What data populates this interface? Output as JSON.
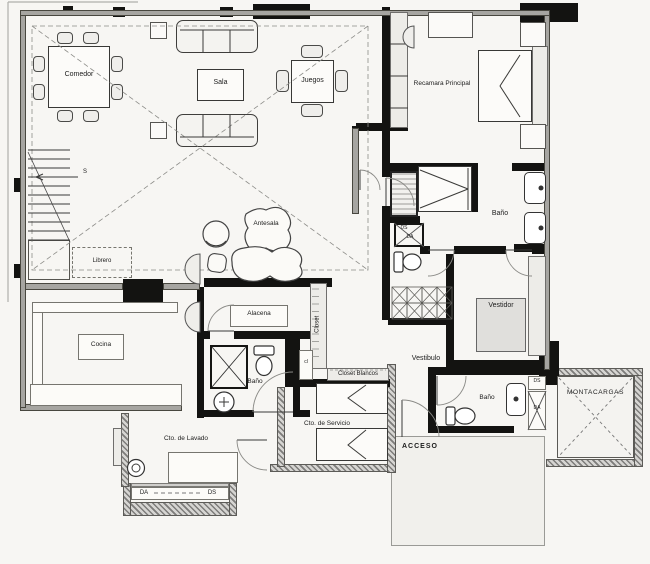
{
  "labels": {
    "comedor": "Comedor",
    "sala": "Sala",
    "juegos": "Juegos",
    "recamara": "Recamara Principal",
    "antesala": "Antesala",
    "librero": "Librero",
    "stair_s": "S",
    "alacena": "Alacena",
    "closet": "Closet",
    "cocina": "Cocina",
    "bano_principal": "Baño",
    "vestidor": "Vestidor",
    "vestibulo": "Vestibulo",
    "closet_blancos": "Closet Blancos",
    "cl": "cl",
    "bano_servicio": "Baño",
    "cto_lavado": "Cto. de Lavado",
    "cto_servicio": "Cto. de Servicio",
    "da_balcon": "DA",
    "ds_balcon": "DS",
    "acceso": "ACCESO",
    "bano_acceso": "Baño",
    "ds_acceso": "DS",
    "da_acceso": "DA",
    "montacargas": "MONTACARGAS",
    "ds_principal": "DS",
    "da_principal": "DA"
  },
  "colors": {
    "paper": "#f7f6f3",
    "wall_gray": "#a6a5a1",
    "wall_black": "#131311",
    "line": "#3a3a38"
  }
}
